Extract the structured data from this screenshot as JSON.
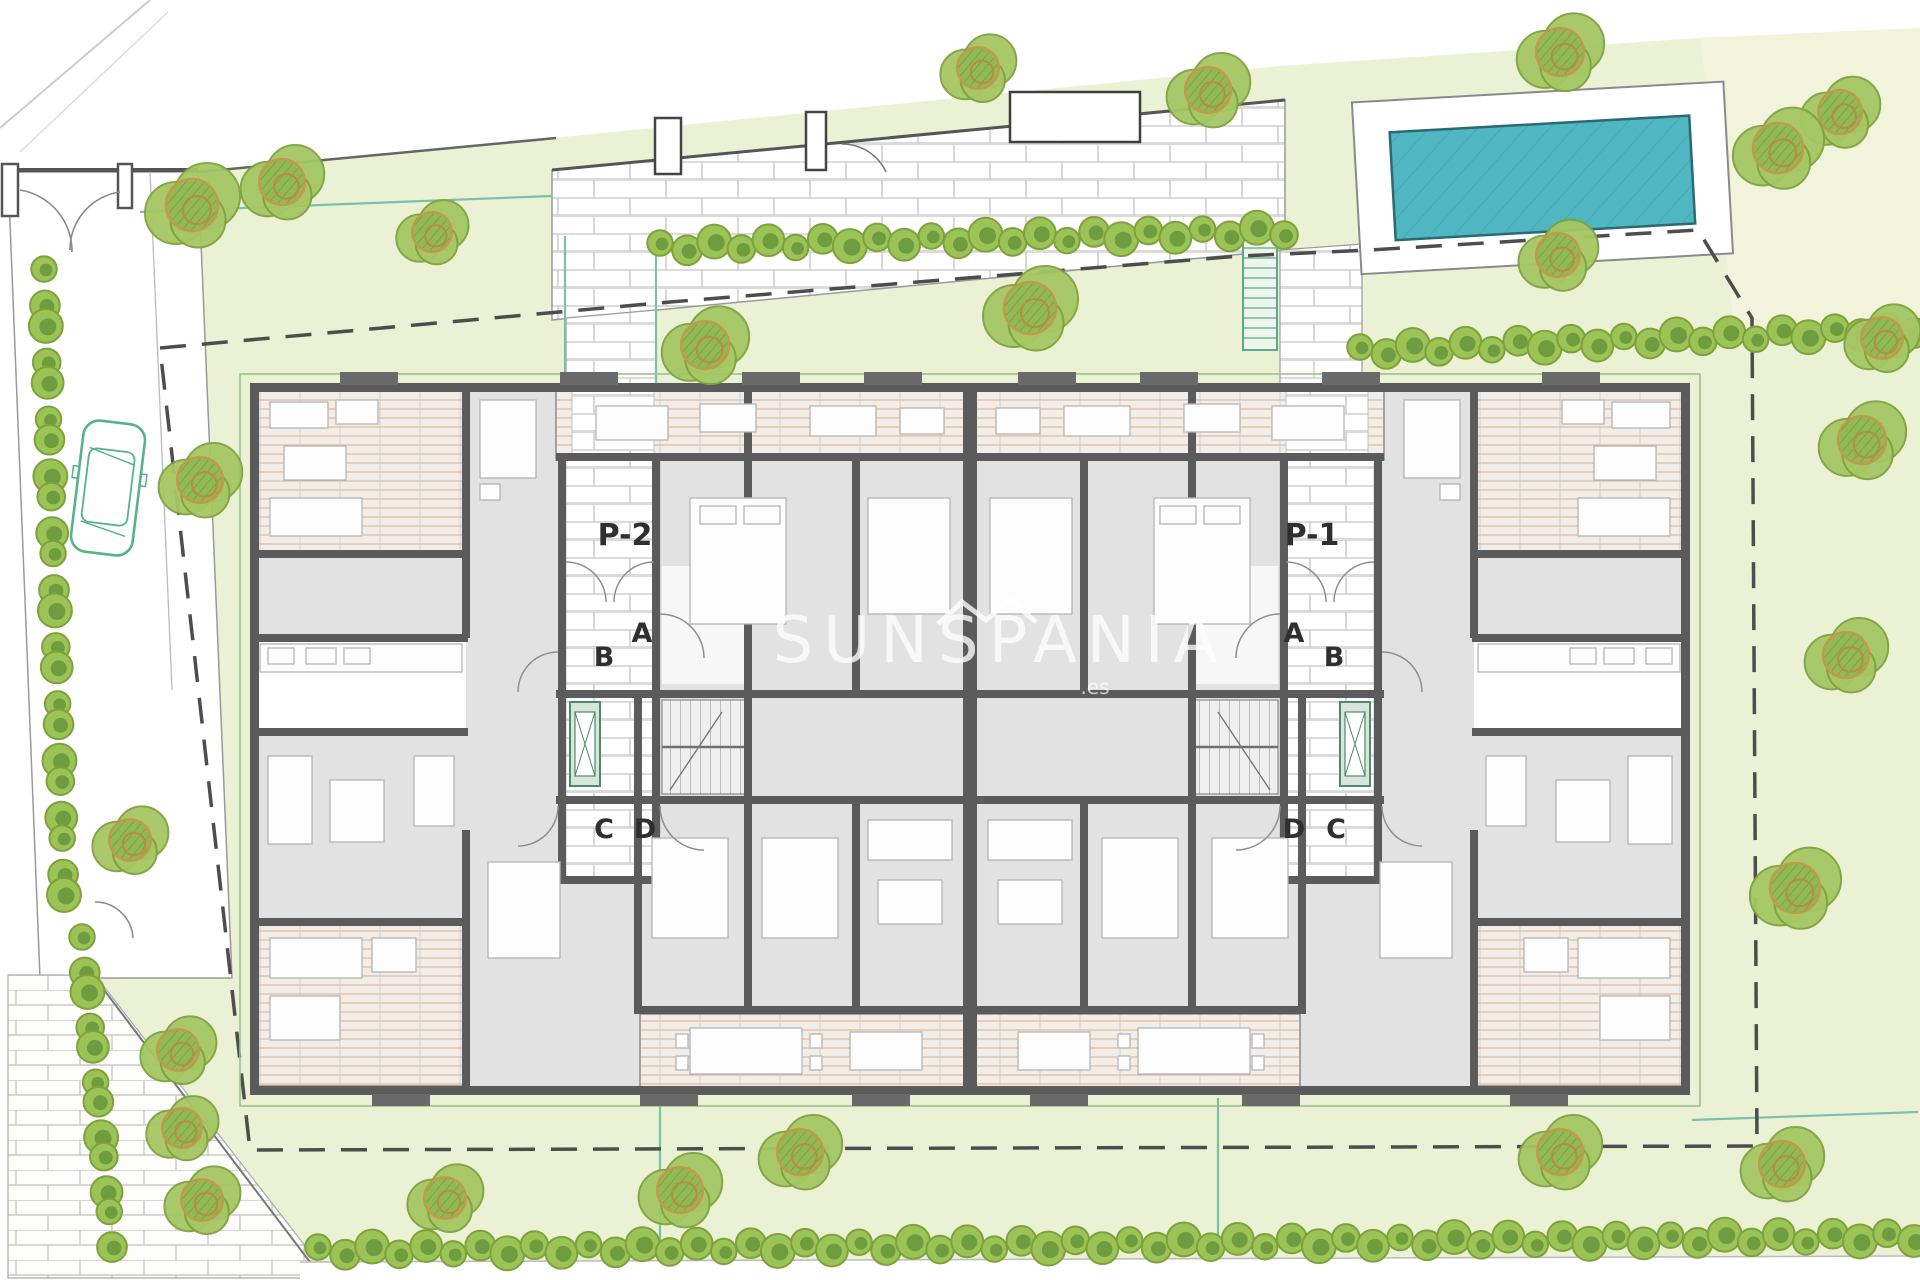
{
  "watermark": {
    "text": "SUNSPANIA",
    "domain_suffix": ".es"
  },
  "plan_labels": [
    {
      "text": "P-2",
      "x": 625,
      "y": 545,
      "size": 30,
      "weight": "bold"
    },
    {
      "text": "P-1",
      "x": 1312,
      "y": 545,
      "size": 30,
      "weight": "bold"
    },
    {
      "text": "A",
      "x": 642,
      "y": 642,
      "size": 27,
      "weight": "600"
    },
    {
      "text": "B",
      "x": 604,
      "y": 666,
      "size": 27,
      "weight": "600"
    },
    {
      "text": "C",
      "x": 604,
      "y": 838,
      "size": 27,
      "weight": "600"
    },
    {
      "text": "D",
      "x": 645,
      "y": 838,
      "size": 27,
      "weight": "600"
    },
    {
      "text": "A",
      "x": 1294,
      "y": 642,
      "size": 27,
      "weight": "600"
    },
    {
      "text": "B",
      "x": 1334,
      "y": 666,
      "size": 27,
      "weight": "600"
    },
    {
      "text": "D",
      "x": 1294,
      "y": 838,
      "size": 27,
      "weight": "600"
    },
    {
      "text": "C",
      "x": 1336,
      "y": 838,
      "size": 27,
      "weight": "600"
    }
  ],
  "palette": {
    "lawn": "#eaf1d4",
    "lawn_pale": "#f1f4da",
    "pool_water": "#4fb6c2",
    "pool_edge": "#2b6a72",
    "wall_gray": "#5b5b5b",
    "room_gray": "#e2e2e2",
    "terrace_line": "#d8b098",
    "brick_line": "#cfcfcf",
    "hedge_green": "#9cc355",
    "hedge_core": "#6f9c3f",
    "tree_green": "#a5c764",
    "tree_accent": "#b98c3e",
    "fence_teal": "#79c0a8",
    "car_green": "#57b28b",
    "boundary_dash": "#4d4d4d",
    "label_ink": "#2f2f2f"
  },
  "pool": {
    "x": 1356,
    "y": 92,
    "w": 372,
    "h": 172,
    "water_inset_x": 36,
    "water_inset_y": 32,
    "angle": -3.2,
    "cx": 1540,
    "cy": 170
  },
  "car": {
    "x": 108,
    "y": 488,
    "len": 132,
    "wid": 62,
    "angle": 7
  },
  "boundary": {
    "dash": "26 16",
    "points": [
      [
        160,
        348
      ],
      [
        670,
        302
      ],
      [
        1240,
        256
      ],
      [
        1370,
        250
      ],
      [
        1698,
        230
      ],
      [
        1752,
        318
      ],
      [
        1757,
        1146
      ],
      [
        250,
        1150
      ],
      [
        160,
        348
      ]
    ]
  },
  "fences": [
    [
      140,
      212,
      552,
      196
    ],
    [
      565,
      236,
      565,
      388
    ],
    [
      656,
      234,
      656,
      388
    ],
    [
      660,
      1098,
      660,
      1248
    ],
    [
      1218,
      1098,
      1218,
      1246
    ],
    [
      1692,
      1120,
      1918,
      1112
    ]
  ],
  "hedges": [
    {
      "x1": 660,
      "y1": 246,
      "x2": 1284,
      "y2": 230,
      "r": 15,
      "spacing": 27
    },
    {
      "x1": 1360,
      "y1": 350,
      "x2": 1914,
      "y2": 328,
      "r": 15,
      "spacing": 27
    },
    {
      "x1": 44,
      "y1": 272,
      "x2": 64,
      "y2": 898,
      "r": 15,
      "spacing": 28
    },
    {
      "x1": 82,
      "y1": 940,
      "x2": 112,
      "y2": 1242,
      "r": 15,
      "spacing": 28
    },
    {
      "x1": 318,
      "y1": 1250,
      "x2": 1914,
      "y2": 1236,
      "r": 15,
      "spacing": 27
    }
  ],
  "trees": [
    [
      192,
      205,
      50
    ],
    [
      282,
      182,
      44
    ],
    [
      432,
      232,
      38
    ],
    [
      200,
      480,
      44
    ],
    [
      130,
      840,
      40
    ],
    [
      705,
      345,
      46
    ],
    [
      1030,
      308,
      50
    ],
    [
      978,
      68,
      40
    ],
    [
      1208,
      90,
      44
    ],
    [
      1560,
      52,
      46
    ],
    [
      1840,
      112,
      42
    ],
    [
      1778,
      148,
      48
    ],
    [
      1558,
      255,
      42
    ],
    [
      1882,
      338,
      40
    ],
    [
      1862,
      440,
      46
    ],
    [
      1846,
      655,
      44
    ],
    [
      1795,
      888,
      48
    ],
    [
      178,
      1050,
      40
    ],
    [
      182,
      1128,
      38
    ],
    [
      202,
      1200,
      40
    ],
    [
      445,
      1198,
      40
    ],
    [
      680,
      1190,
      44
    ],
    [
      800,
      1152,
      44
    ],
    [
      1560,
      1152,
      44
    ],
    [
      1782,
      1164,
      44
    ]
  ],
  "stair_by_pool": {
    "x": 1243,
    "y": 228,
    "w": 34,
    "h": 122
  }
}
